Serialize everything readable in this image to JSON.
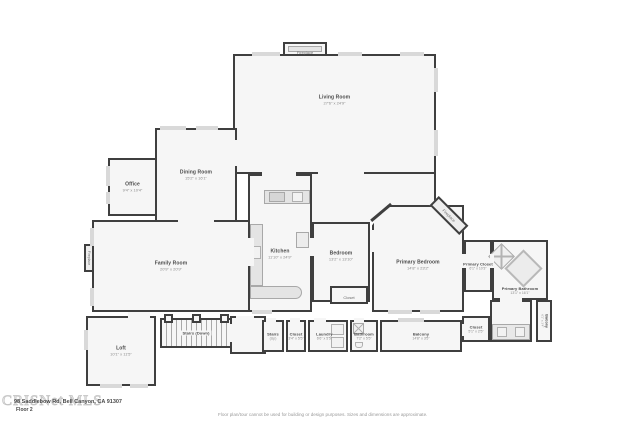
{
  "colors": {
    "wall": "#3f3f3f",
    "room_fill": "#f6f6f6",
    "window": "#d9d9d9",
    "fixture": "#e4e4e4",
    "label": "#4a4a4a",
    "dims": "#8a8a8a"
  },
  "rooms": {
    "fireplace_top": {
      "name": "Fireplace"
    },
    "living": {
      "name": "Living Room",
      "dims": "27'6\" x 24'9\""
    },
    "dining": {
      "name": "Dining Room",
      "dims": "15'2\" x 16'1\""
    },
    "office": {
      "name": "Office",
      "dims": "9'4\" x 10'4\""
    },
    "family": {
      "name": "Family Room",
      "dims": "20'9\" x 20'9\""
    },
    "family_fireplace": {
      "name": "Fireplace"
    },
    "kitchen": {
      "name": "Kitchen",
      "dims": "11'10\" x 24'9\""
    },
    "bedroom": {
      "name": "Bedroom",
      "dims": "13'2\" x 13'10\""
    },
    "bedroom_closet": {
      "name": "Closet"
    },
    "primary_bedroom": {
      "name": "Primary Bedroom",
      "dims": "14'8\" x 23'2\""
    },
    "primary_fireplace": {
      "name": "Fireplace"
    },
    "primary_closet": {
      "name": "Primary Closet",
      "dims": "6'1\" x 10'3\""
    },
    "primary_bathroom": {
      "name": "Primary Bathroom",
      "dims": "13'1\" x 16'1\""
    },
    "loft": {
      "name": "Loft",
      "dims": "10'1\" x 11'5\""
    },
    "stairs_down": {
      "name": "Stairs (Down)"
    },
    "stairs_up": {
      "name": "Stairs",
      "sub": "(Up)"
    },
    "hall_closet": {
      "name": "Closet",
      "dims": "3'4\" x 5'5\""
    },
    "laundry": {
      "name": "Laundry",
      "dims": "6'6\" x 5'5\""
    },
    "hall_bathroom": {
      "name": "Bathroom",
      "dims": "7'2\" x 5'5\""
    },
    "balcony": {
      "name": "Balcony",
      "dims": "14'8\" x 3'5\""
    },
    "right_closet": {
      "name": "Closet",
      "dims": "5'1\" x 2'5\""
    },
    "side_balcony": {
      "name": "Balcony",
      "dims": "6'1\" x 3'4\""
    }
  },
  "footer": {
    "watermark": "CRISNet MLS",
    "address": "98 Saddlebow Rd, Bell Canyon, CA 91307",
    "floor_label": "Floor 2",
    "disclaimer": "Floor plan/tour cannot be used for building or design purposes. Sizes and dimensions are approximate."
  }
}
